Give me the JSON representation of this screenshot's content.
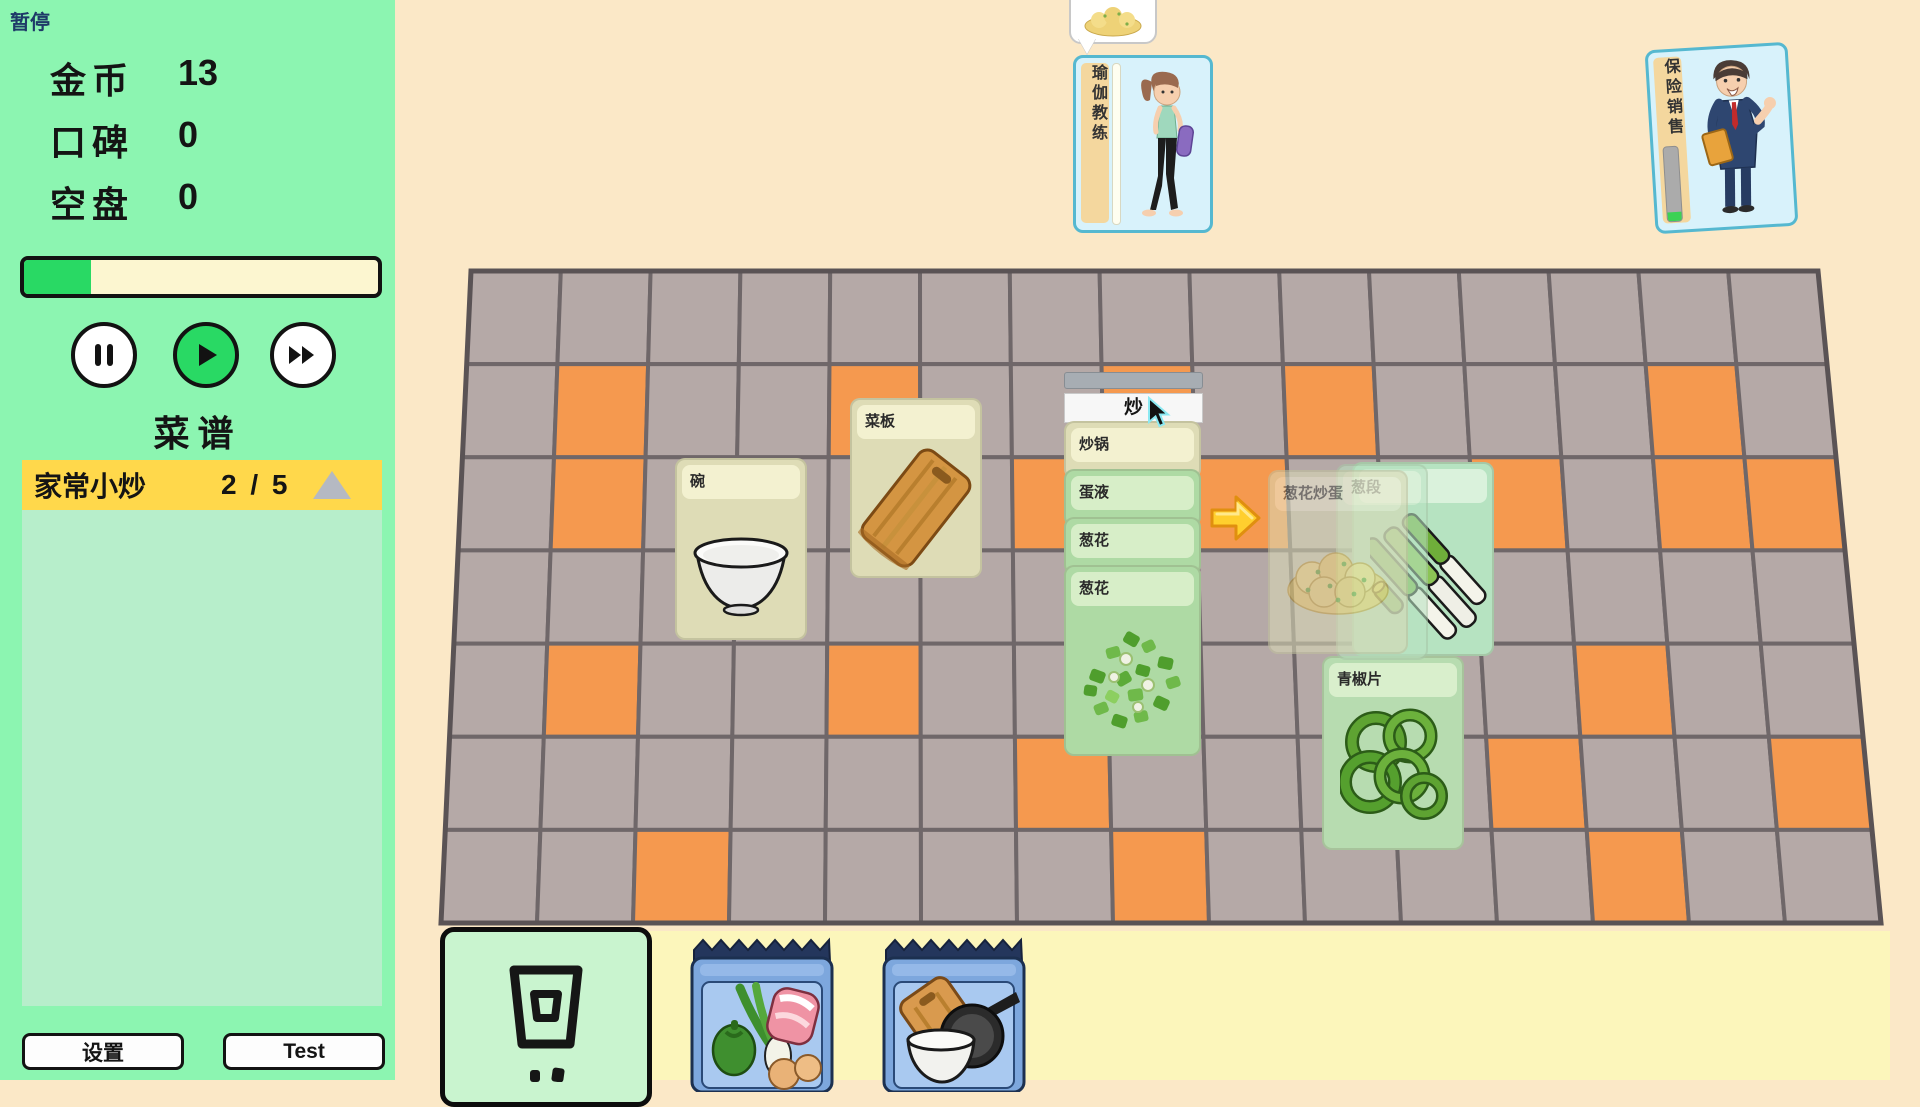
{
  "hud": {
    "pause_tag": "暂停",
    "stats": [
      {
        "label": "金币",
        "value": "13"
      },
      {
        "label": "口碑",
        "value": "0"
      },
      {
        "label": "空盘",
        "value": "0"
      }
    ],
    "time_progress_pct": 19,
    "recipes_title": "菜谱",
    "recipe": {
      "name": "家常小炒",
      "count": "2 / 5"
    },
    "settings_label": "设置",
    "test_label": "Test"
  },
  "action": {
    "label": "炒"
  },
  "cards": {
    "bowl": "碗",
    "cutting_board": "菜板",
    "stack": [
      "炒锅",
      "蛋液",
      "葱花",
      "葱花"
    ],
    "result": "葱花炒蛋",
    "scallion_segment": "葱段",
    "pepper": "青椒片"
  },
  "customers": [
    {
      "name": "瑜伽教练",
      "patience_pct": 100
    },
    {
      "name": "保险销售",
      "patience_pct": 12
    }
  ],
  "board": {
    "grid": {
      "cols": 15,
      "rows": 7,
      "corners": {
        "tl": [
          471,
          271
        ],
        "tr": [
          1818,
          271
        ],
        "bl": [
          441,
          923
        ],
        "br": [
          1881,
          923
        ]
      },
      "tile_color": "#b5a9a7",
      "orange_color": "#f5994f",
      "grout_color": "#6f6769",
      "edge_color": "#5a5355",
      "orange_tiles": [
        [
          1,
          1
        ],
        [
          4,
          1
        ],
        [
          7,
          1
        ],
        [
          9,
          1
        ],
        [
          13,
          1
        ],
        [
          1,
          2
        ],
        [
          6,
          2
        ],
        [
          8,
          2
        ],
        [
          11,
          2
        ],
        [
          13,
          2
        ],
        [
          14,
          2
        ],
        [
          1,
          4
        ],
        [
          4,
          4
        ],
        [
          12,
          4
        ],
        [
          6,
          5
        ],
        [
          11,
          5
        ],
        [
          14,
          5
        ],
        [
          2,
          6
        ],
        [
          7,
          6
        ],
        [
          12,
          6
        ]
      ]
    }
  },
  "colors": {
    "sidebar_green": "#8cf5b1",
    "accent_green": "#29d964",
    "recipe_yellow": "#ffd84b",
    "bg_beige": "#fbe8c7",
    "hand_strip_yellow": "#fcf6bb"
  }
}
